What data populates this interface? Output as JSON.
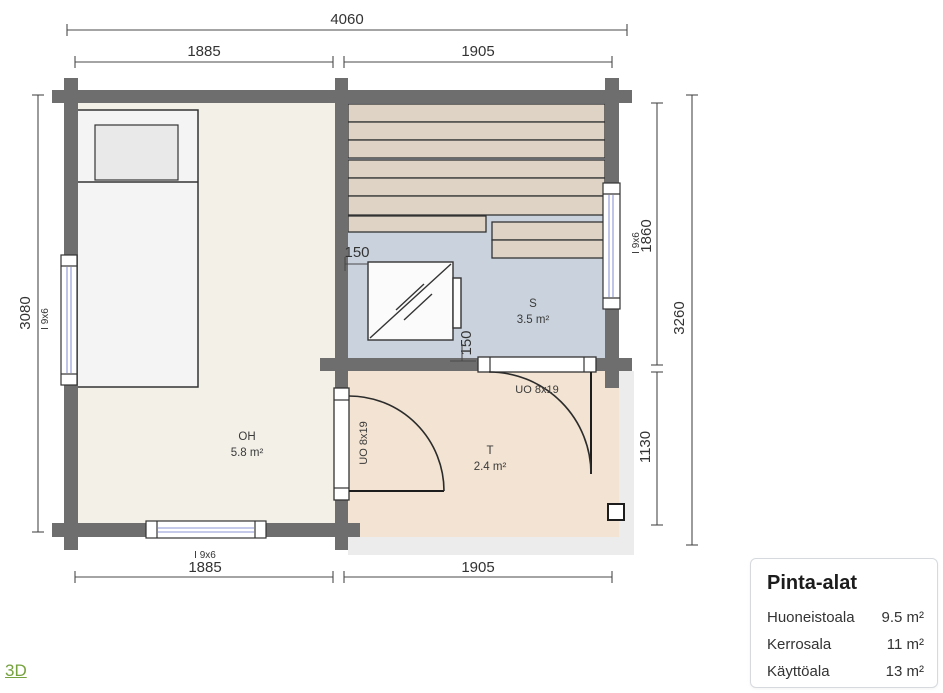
{
  "colors": {
    "wall": "#6e6e6e",
    "floor_oh": "#f3f0e8",
    "floor_s": "#cad3dd",
    "floor_t": "#f2e3d2",
    "deck": "#ececec",
    "bench": "#ded3c5",
    "bed": "#f4f4f4",
    "pillow": "#e9e9e9",
    "stove": "#fbfbfb",
    "window_glass": "#8b93d6",
    "outline": "#333333",
    "dim_line": "#4a4a4a",
    "text": "#333333",
    "link_green": "#76a23e",
    "panel_border": "#d6dade",
    "panel_bg": "#ffffff"
  },
  "dimensions": {
    "top_total": "4060",
    "top_left": "1885",
    "top_right": "1905",
    "left_height": "3080",
    "right_sauna": "1860",
    "right_terrace": "1130",
    "right_total": "3260",
    "bottom_left": "1885",
    "bottom_right": "1905",
    "stove_offset_left": "150",
    "stove_offset_bottom": "150"
  },
  "windows": {
    "left_label": "I 9x6",
    "right_label": "I 9x6",
    "bottom_label": "I 9x6"
  },
  "rooms": {
    "oh": {
      "name": "OH",
      "area": "5.8 m²"
    },
    "s": {
      "name": "S",
      "area": "3.5 m²"
    },
    "t": {
      "name": "T",
      "area": "2.4 m²"
    }
  },
  "doors": {
    "terrace_top_label": "UO 8x19",
    "terrace_left_label": "UO 8x19"
  },
  "panel": {
    "title": "Pinta-alat",
    "rows": [
      {
        "label": "Huoneistoala",
        "value": "9.5 m²"
      },
      {
        "label": "Kerrosala",
        "value": "11 m²"
      },
      {
        "label": "Käyttöala",
        "value": "13 m²"
      }
    ]
  },
  "links": {
    "view_3d": "3D"
  }
}
